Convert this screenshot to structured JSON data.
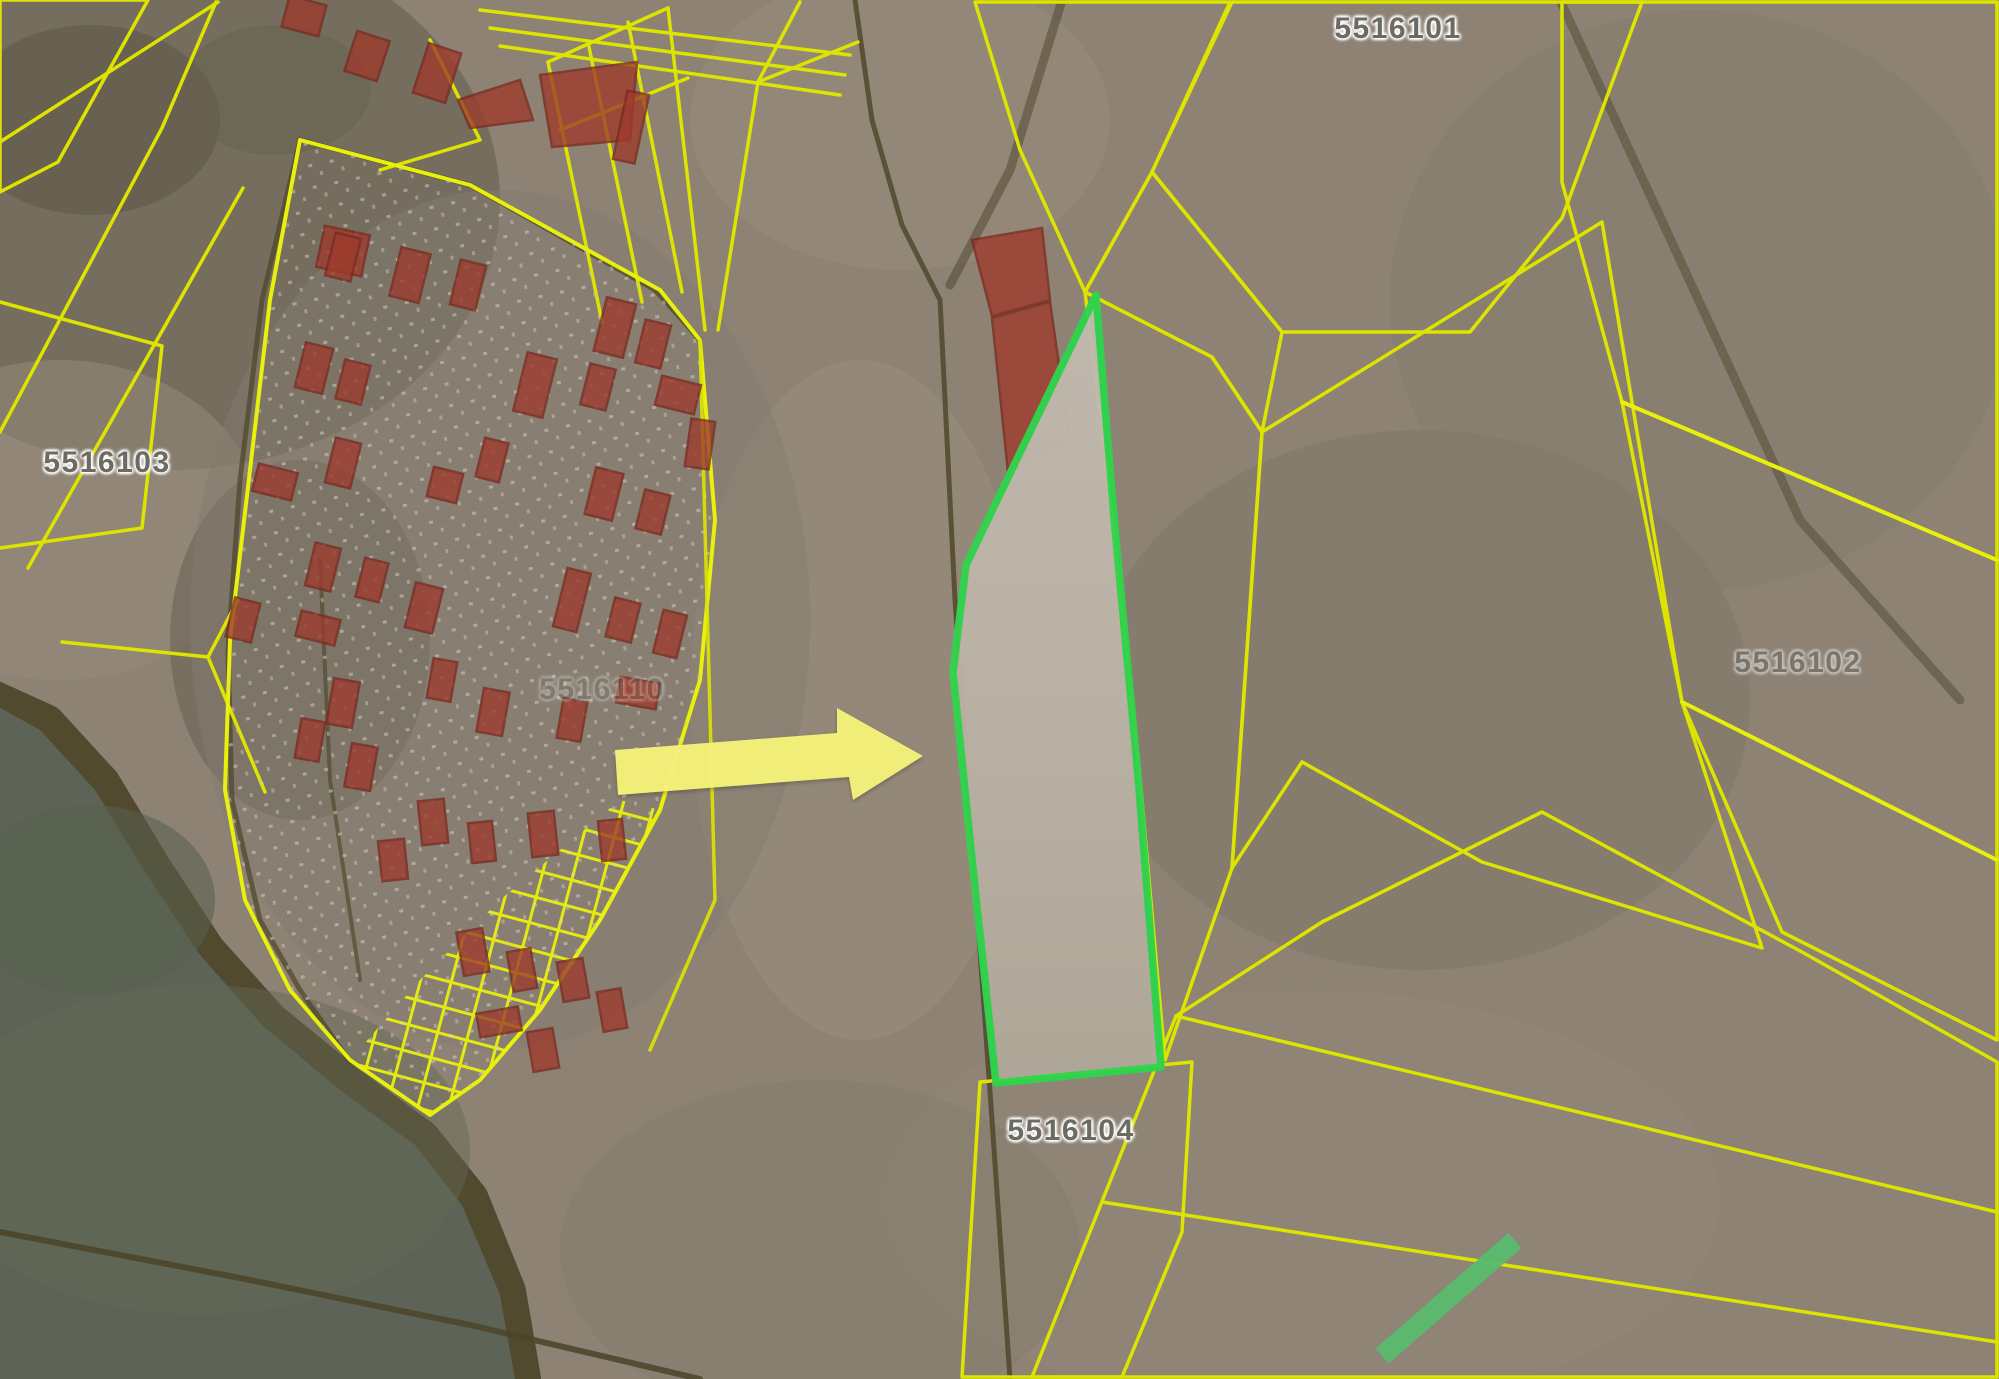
{
  "map": {
    "kind": "satellite-cadastral-map",
    "highlighted_parcel": {
      "outline_color_name": "green",
      "fill_appearance": "light plowed field"
    },
    "annotations": {
      "arrow_direction": "right",
      "arrow_points_to": "highlighted green parcel"
    }
  },
  "labels": [
    {
      "id": "block-5516103",
      "text": "5516103"
    },
    {
      "id": "block-5516101",
      "text": "5516101"
    },
    {
      "id": "block-5516104",
      "text": "5516104"
    },
    {
      "id": "block-5516102",
      "text": "5516102"
    },
    {
      "id": "block-5516110",
      "text": "5516110"
    }
  ],
  "colors": {
    "parcel-line": "#dde400",
    "parcel-line-bright": "#e9f00a",
    "red-parcel-fill": "#9e3a2c",
    "red-parcel-stroke": "#7c2a1e",
    "highlight-stroke": "#30d44c",
    "highlight-fill": "#bab2a4",
    "arrow-fill": "#f5f17a",
    "lake": "#5d6457",
    "shore": "#564c3a",
    "terrain": "#8d8274",
    "terrain-dark": "#6e6757",
    "terrain-light": "#9c907e",
    "road": "#4b4428",
    "green-bar": "#58ba6c",
    "label-text": "#6b6b64",
    "label-halo": "#ffffff"
  }
}
